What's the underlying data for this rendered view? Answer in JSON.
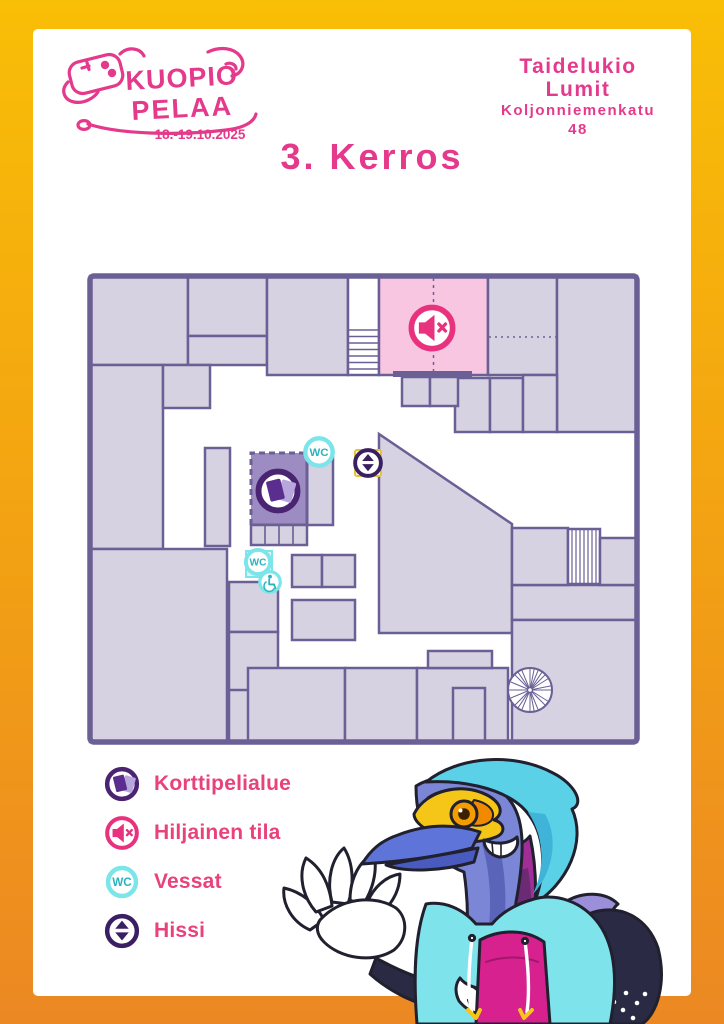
{
  "brand": {
    "name_line1": "KUOPIO",
    "name_line2": "PELAA",
    "dates": "18.-19.10.2025"
  },
  "venue": {
    "lines": [
      "Taidelukio",
      "Lumit",
      "Koljonniemenkatu",
      "48"
    ]
  },
  "page": {
    "title": "3. Kerros"
  },
  "map": {
    "wc_label": "WC",
    "icons": [
      {
        "name": "quiet-room-icon",
        "meaning": "Hiljainen tila"
      },
      {
        "name": "card-game-area-icon",
        "meaning": "Korttipelialue"
      },
      {
        "name": "wc-icon",
        "meaning": "Vessat"
      },
      {
        "name": "accessible-wc-icon",
        "meaning": "Esteetön WC"
      },
      {
        "name": "elevator-icon",
        "meaning": "Hissi"
      },
      {
        "name": "stairs",
        "meaning": "Portaat"
      },
      {
        "name": "spiral-stairs",
        "meaning": "Kierreportaat"
      }
    ]
  },
  "legend": {
    "items": [
      {
        "icon": "card-game-icon",
        "label": "Korttipelialue"
      },
      {
        "icon": "muted-speaker-icon",
        "label": "Hiljainen tila"
      },
      {
        "icon": "wc-icon",
        "icon_label": "WC",
        "label": "Vessat"
      },
      {
        "icon": "elevator-icon",
        "label": "Hissi"
      }
    ]
  },
  "colors": {
    "brand_pink": "#E5398B",
    "legend_text_pink": "#E8417C",
    "wall_purple": "#6A6096",
    "room_fill": "#D7D2E1",
    "quiet_room_pink": "#F9C6E2",
    "card_area_purple": "#9C8CC2",
    "wc_cyan": "#7CE5EA",
    "wc_teal": "#2BB3BE",
    "icon_dark_purple": "#3B1F63",
    "card_ring_purple": "#4A2472",
    "frame_top": "#F9BE06",
    "frame_bottom": "#EC8823"
  }
}
